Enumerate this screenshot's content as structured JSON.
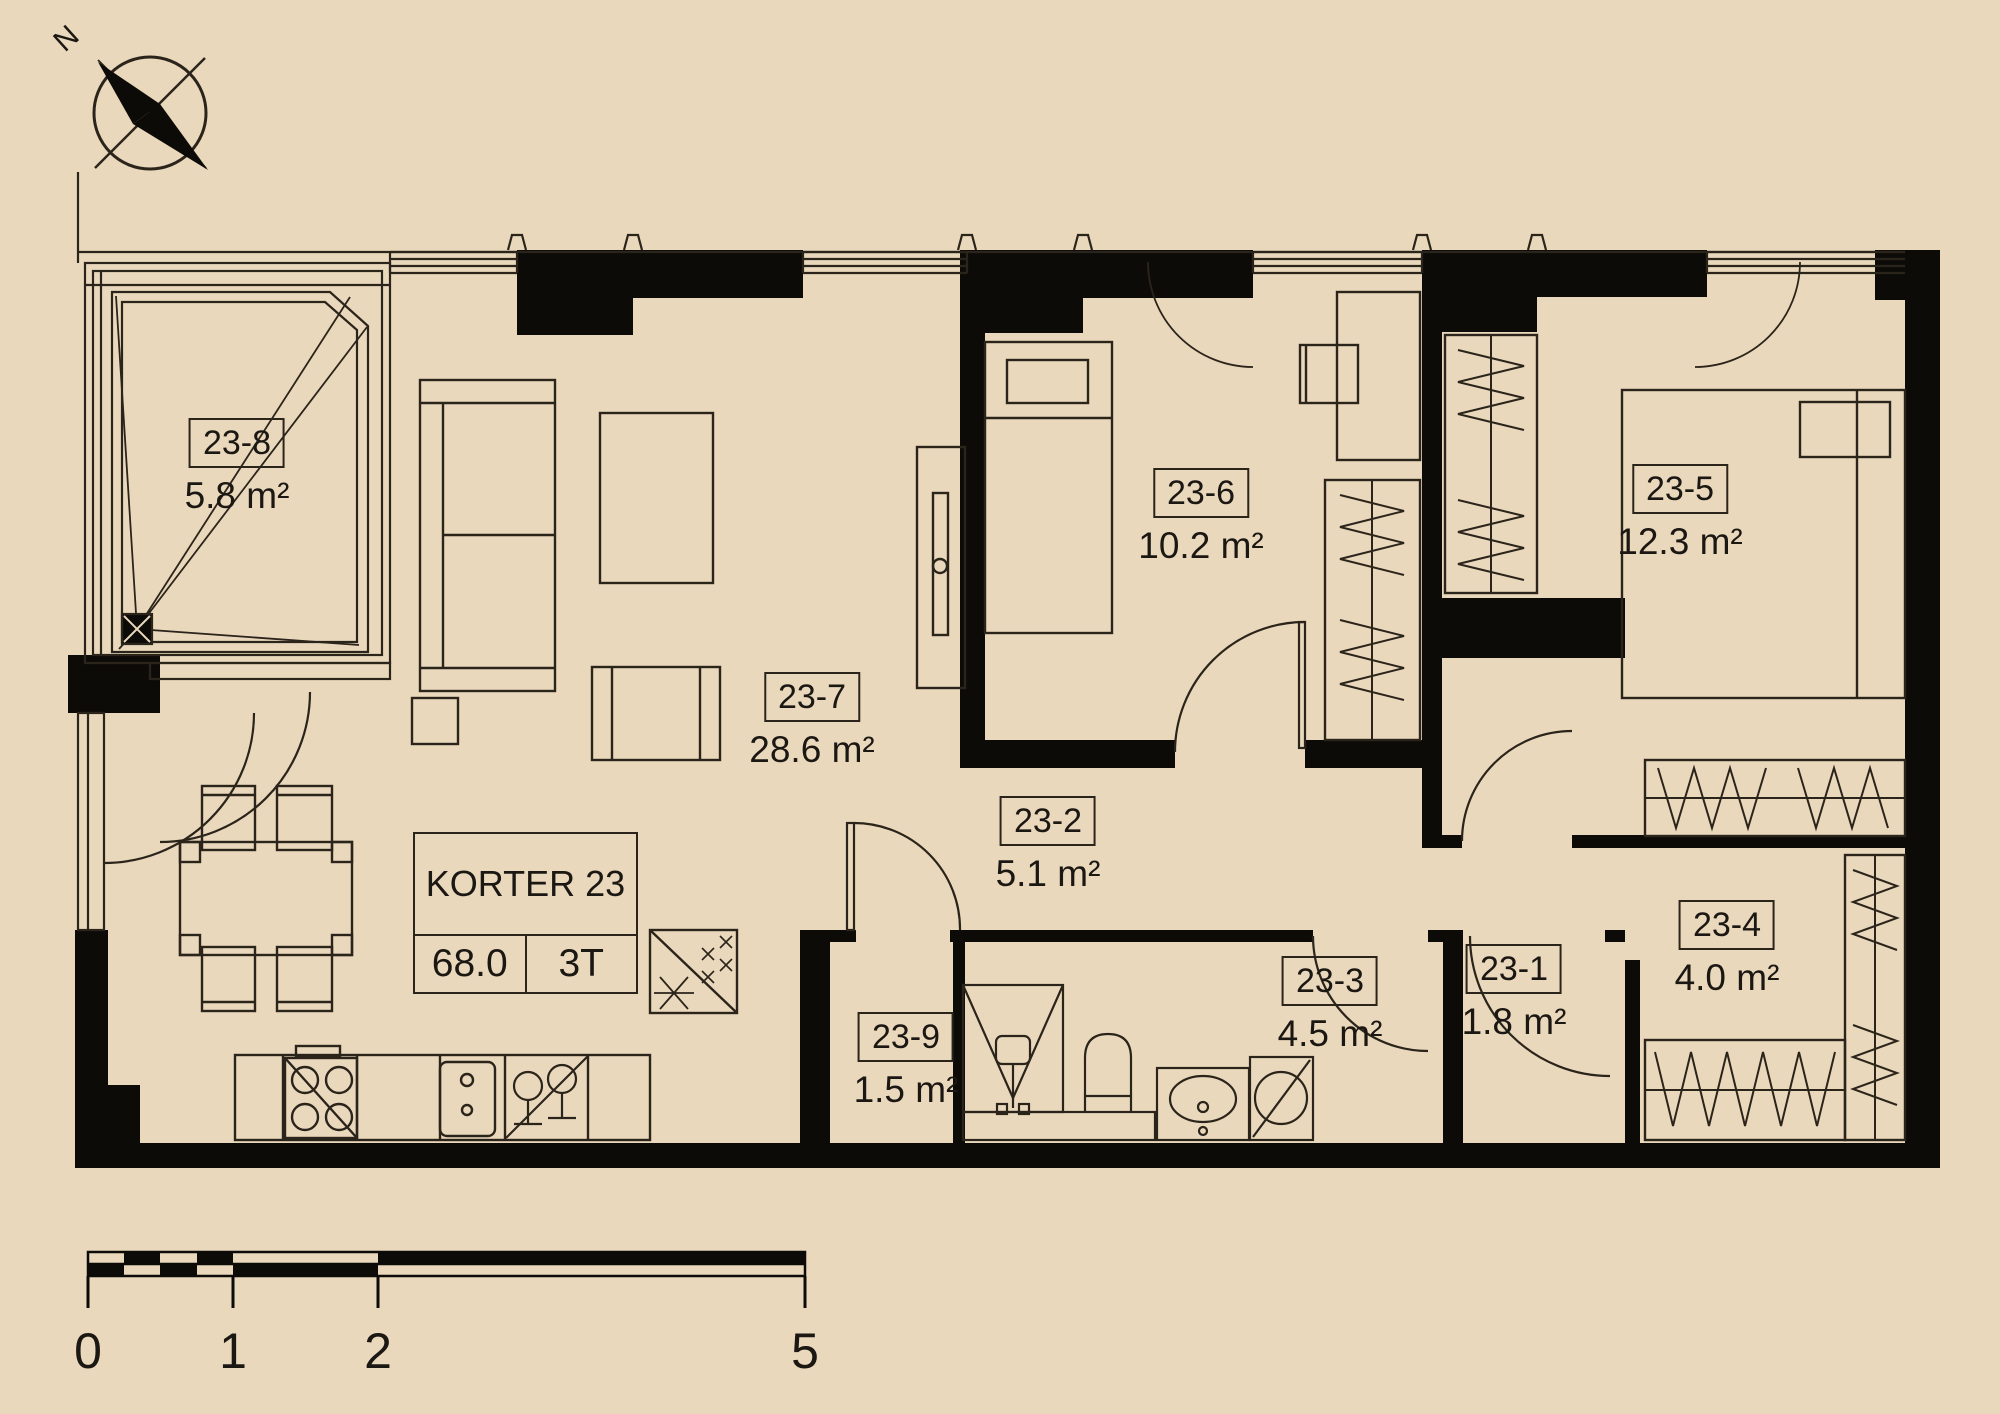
{
  "plan": {
    "compass": {
      "north_label": "N"
    },
    "apartment_table": {
      "name": "KORTER 23",
      "area_value": "68.0",
      "type_value": "3T"
    },
    "rooms": {
      "r1": {
        "id": "23-1",
        "area": "1.8 m²"
      },
      "r2": {
        "id": "23-2",
        "area": "5.1 m²"
      },
      "r3": {
        "id": "23-3",
        "area": "4.5 m²"
      },
      "r4": {
        "id": "23-4",
        "area": "4.0 m²"
      },
      "r5": {
        "id": "23-5",
        "area": "12.3 m²"
      },
      "r6": {
        "id": "23-6",
        "area": "10.2 m²"
      },
      "r7": {
        "id": "23-7",
        "area": "28.6 m²"
      },
      "r8": {
        "id": "23-8",
        "area": "5.8 m²"
      },
      "r9": {
        "id": "23-9",
        "area": "1.5 m²"
      }
    },
    "scale_bar": {
      "labels": [
        "0",
        "1",
        "2",
        "5"
      ]
    },
    "colors": {
      "background": "#ead8bc",
      "line": "#2b241b",
      "wall": "#0d0b08"
    }
  }
}
